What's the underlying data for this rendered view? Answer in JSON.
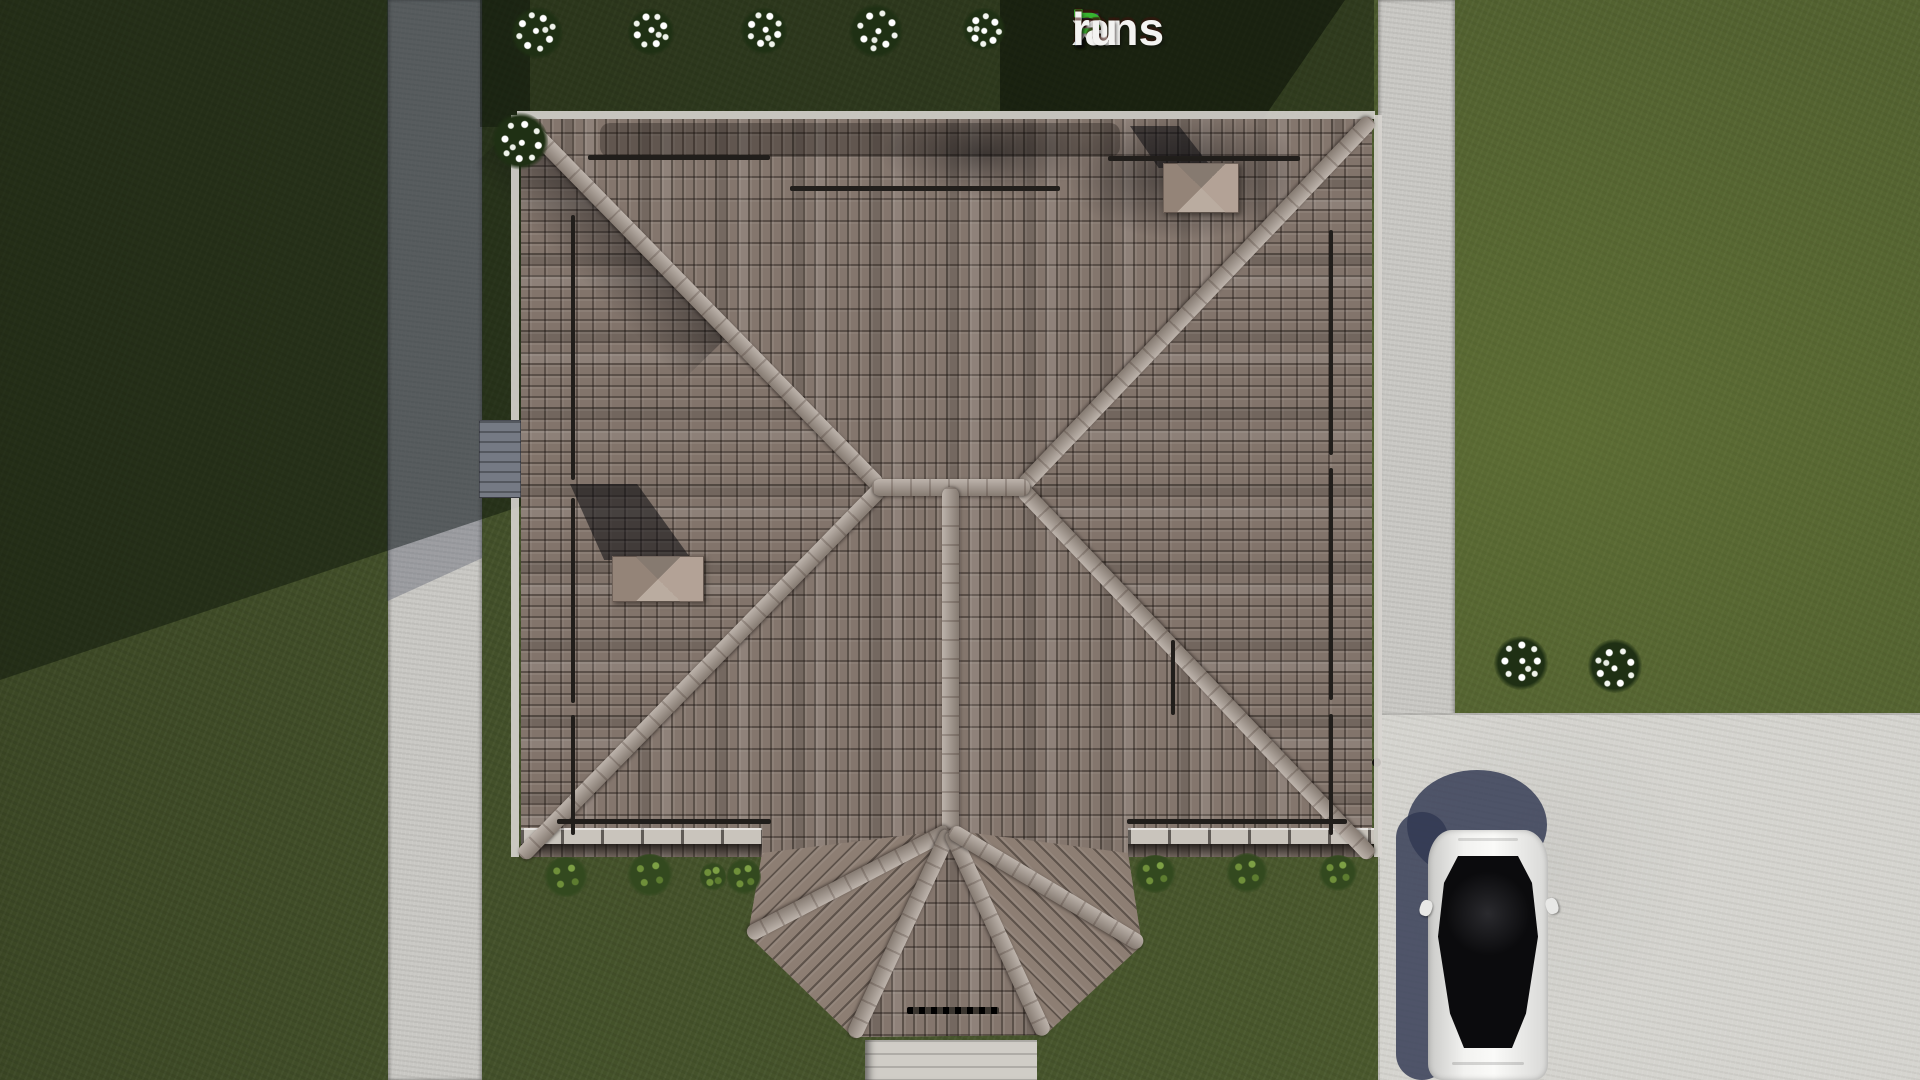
{
  "page": {
    "type": "3d-aerial-architectural-render",
    "description": "Top-down render of a single-family house with brown hip tile roof, lawn, two concrete walkways, driveway pad and a white parked car"
  },
  "logo": {
    "text": "FixPlans.ru",
    "segments": [
      {
        "text": "F",
        "color": "#2f6bd4"
      },
      {
        "text": "i",
        "color": "#f3f3f1",
        "dot_color": "#38b430"
      },
      {
        "text": "x",
        "color": "#f3f3f1"
      },
      {
        "text": "P",
        "color": "#38b430"
      },
      {
        "text": "lans",
        "color": "#f3f3f1"
      },
      {
        "text": ".",
        "color": "#2f6bd4"
      },
      {
        "text": "ru",
        "color": "#f3f3f1"
      }
    ]
  },
  "palette": {
    "grass": "#47552c",
    "grass_shadow": "#1d2a14",
    "path_concrete": "#c9c8c4",
    "path_in_shadow": "#6e7382",
    "driveway_pad": "#d5d4cf",
    "roof_tile_base": "#84766d",
    "roof_tile_dark": "#55493f",
    "ridge_cap": "#a3968b",
    "chimney_cap": "#9b8e84",
    "gutter": "#c9c4bc",
    "deck_wood": "#757a84",
    "car_body": "#ececea",
    "car_glass": "#0b0b0d",
    "cast_shadow_blue": "#343a52",
    "flower_white": "#ffffff",
    "bush_green": "#33491f"
  },
  "scene": {
    "house": {
      "roof_type": "hip",
      "chimneys": 2,
      "snow_guard_bars": true,
      "porch": "half-octagon bay at bottom center"
    },
    "vehicles": [
      {
        "kind": "sedan",
        "color": "white",
        "location": "driveway bottom right"
      }
    ],
    "flower_bushes": 8,
    "shrubs": 7,
    "walkways": 2,
    "time_of_day_shadows": "long shadows toward upper left"
  }
}
